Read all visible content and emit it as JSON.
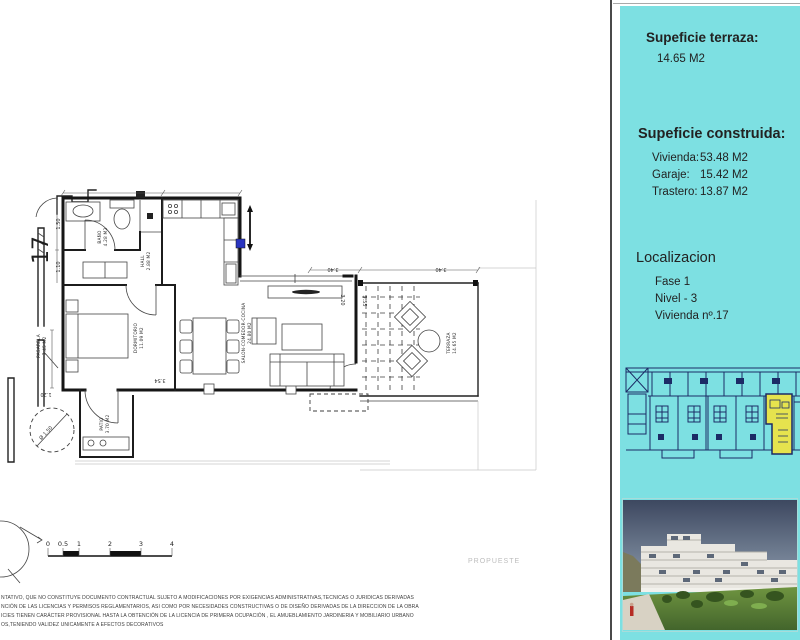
{
  "plan": {
    "unit_number": "17",
    "watermark": "PROPUESTE",
    "rooms": {
      "bano": {
        "name": "BAÑO",
        "area": "4.28 M2"
      },
      "hall": {
        "name": "HALL",
        "area": "2.88 M2"
      },
      "dormitorio": {
        "name": "DORMITORIO",
        "area": "11.09 M2"
      },
      "salon": {
        "name": "SALON-COMEDOR-COCINA",
        "area": "24.80 M2"
      },
      "terraza": {
        "name": "TERRAZA",
        "area": "14.65 M2"
      },
      "patio": {
        "name": "PATIO",
        "area": "3.70 M2"
      },
      "pasarela": {
        "name": "PASARELA",
        "area": "7.45 M2"
      }
    },
    "dims": {
      "top_left": "3.40",
      "top_right": "3.40",
      "living_height": "3.20",
      "terrace_height": "3.55",
      "bedroom_width": "3.54",
      "walkway": "1.20",
      "turning_circle": "Ø 1.50",
      "bath": "1.50",
      "hall": "1.10"
    },
    "scalebar": {
      "ticks": [
        "0",
        "0.5",
        "1",
        "2",
        "3",
        "4"
      ]
    }
  },
  "sidebar": {
    "terrace_title": "Supeficie terraza:",
    "terrace_value": "14.65 M2",
    "built_title": "Supeficie construida:",
    "built_rows": [
      {
        "label": "Vivienda:",
        "value": "53.48 M2"
      },
      {
        "label": "Garaje:",
        "value": "15.42 M2"
      },
      {
        "label": "Trastero:",
        "value": "13.87 M2"
      }
    ],
    "location_title": "Localizacion",
    "location_lines": [
      "Fase 1",
      "Nivel - 3",
      "Vivienda nº.17"
    ],
    "colors": {
      "panel": "#7de0e2",
      "highlight": "#e6e34e",
      "plan_ink": "#1c2b66"
    }
  },
  "disclaimer": {
    "lines": [
      "NTATIVO, QUE NO CONSTITUYE DOCUMENTO CONTRACTUAL SUJETO A MODIFICACIONES POR EXIGENCIAS ADMINISTRATIVAS,TECNICAS O JURIDICAS DERIVADAS",
      "NCIÓN DE LAS LICENCIAS Y PERMISOS REGLAMENTARIOS, ASI COMO POR NECESIDADES CONSTRUCTIVAS  O DE DISEÑO DERIVADAS DE LA DIRECCION DE LA OBRA",
      "ICIES TIENEN CARÁCTER PROVISIONAL HASTA LA OBTENCIÓN DE LA LICENCIA DE PRIMERA OCUPACIÓN , EL AMUEBLAMIENTO JARDINERIA Y MOBILIARIO URBANO",
      "OS,TENIENDO VALIDEZ UNICAMENTE  A EFECTOS DECORATIVOS"
    ]
  }
}
